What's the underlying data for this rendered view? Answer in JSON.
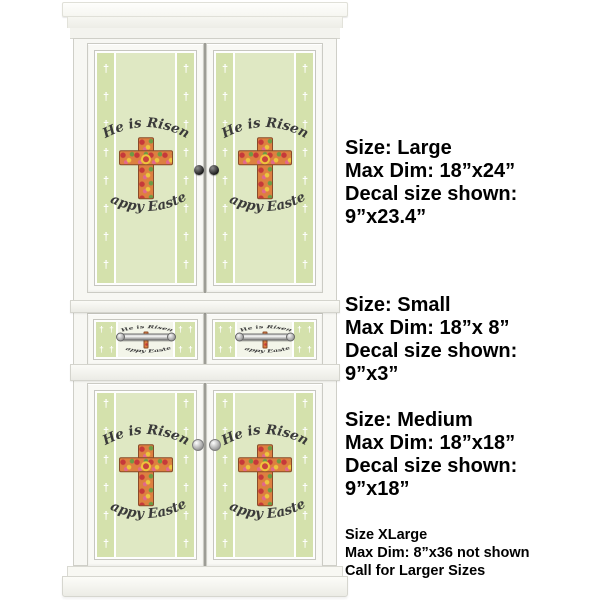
{
  "canvas": {
    "width": 600,
    "height": 600,
    "background": "#ffffff"
  },
  "size_blocks": [
    {
      "lines": [
        "Size: Large",
        "Max Dim: 18”x24”",
        "Decal size shown:",
        "9”x23.4”"
      ]
    },
    {
      "lines": [
        "Size: Small",
        "Max Dim: 18”x 8”",
        "Decal size shown:",
        "9”x3”"
      ]
    },
    {
      "lines": [
        "Size: Medium",
        "Max Dim: 18”x18”",
        "Decal size shown:",
        "9”x18”"
      ]
    }
  ],
  "xlarge_block": {
    "lines": [
      "Size XLarge",
      "Max Dim: 8”x36 not shown",
      "Call for Larger Sizes"
    ]
  },
  "decal": {
    "top_text": "He is Risen",
    "bottom_text": "Happy Easter",
    "stripe_pattern": "† † † † † † † † † † † † † † † † † † † †",
    "drawer_stripe_pattern": "† † † † † † † †",
    "colors": {
      "decal_background": "#dfe8c3",
      "stripe_background": "#d4e1ac",
      "stripe_cross": "#ffffff",
      "script_text": "#3a3a3a",
      "cross_floral_base": "#dd8040",
      "cross_outline": "#8a4a28"
    }
  }
}
